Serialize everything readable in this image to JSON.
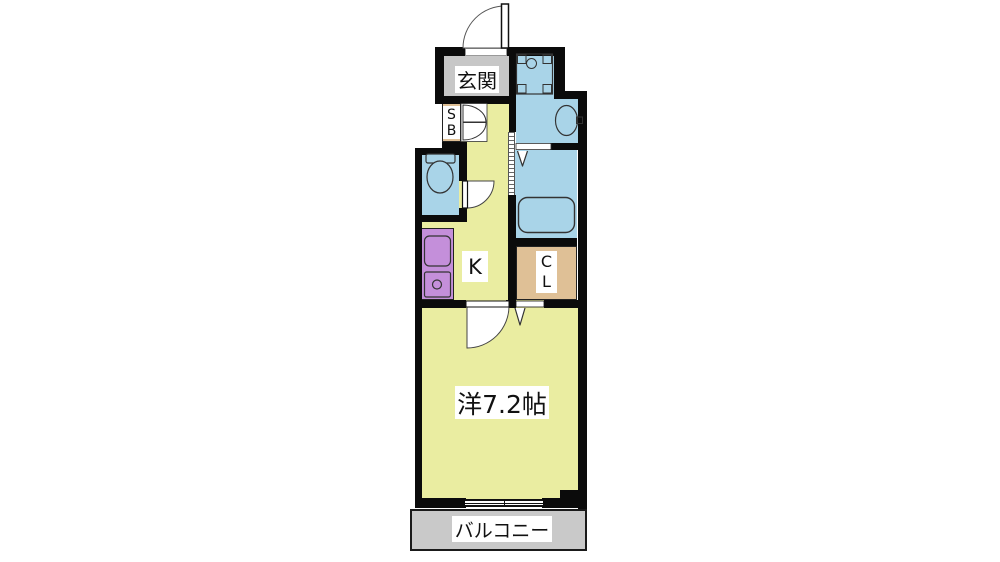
{
  "plan": {
    "title": "1K apartment floor plan",
    "rooms": {
      "genkan": {
        "label": "玄関"
      },
      "shoe_box": {
        "line1": "S",
        "line2": "B"
      },
      "kitchen": {
        "label": "K"
      },
      "closet": {
        "line1": "C",
        "line2": "L"
      },
      "western_room": {
        "label": "洋7.2帖"
      },
      "balcony": {
        "label": "バルコニー"
      }
    },
    "fixtures": [
      "entrance-door",
      "washing-machine-pan",
      "washbasin",
      "toilet",
      "bathtub",
      "bathroom-folding-door",
      "shoe-box-double-doors",
      "kitchen-sink",
      "gas-stove",
      "room-swing-door",
      "closet-folding-door",
      "balcony-sliding-window"
    ],
    "colors": {
      "wall": "#0b0b0b",
      "room_yellow": "#EAEDA1",
      "water_blue": "#A9D4E8",
      "entrance_gray": "#C7C7C7",
      "storage_tan": "#DFC096",
      "kitchen_purple": "#C48FDA",
      "balcony_gray": "#C9C9C9"
    }
  }
}
